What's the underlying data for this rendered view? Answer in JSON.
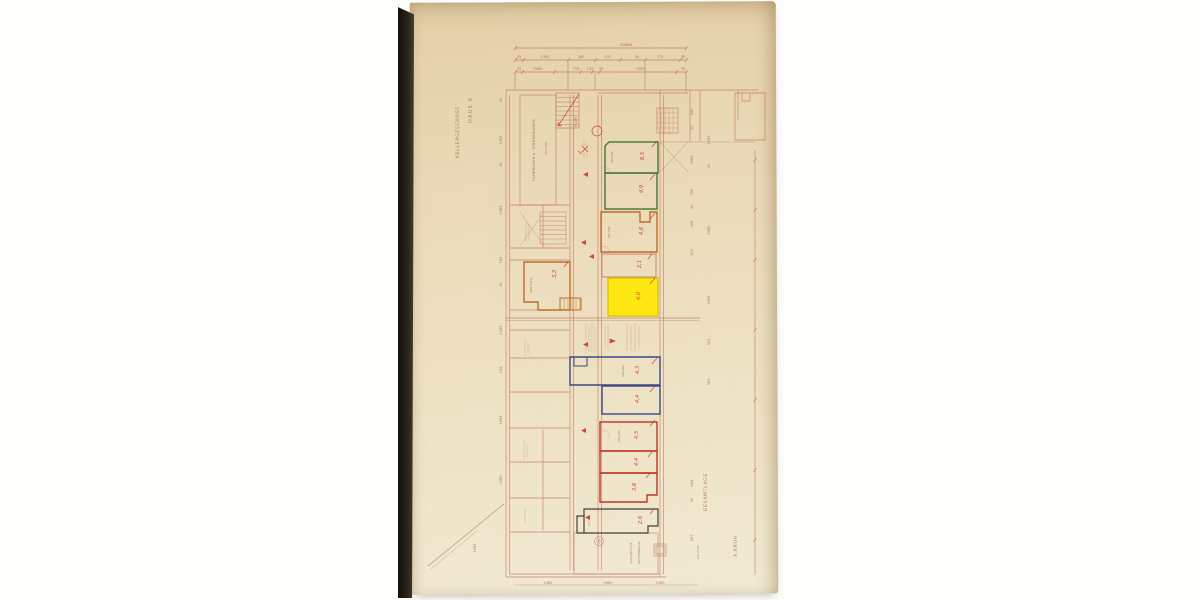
{
  "titles": {
    "haus": "HAUS 9",
    "geschoss": "KELLERGESCHOSS",
    "gesamtlage": "GESAMTLAGE",
    "architect": "A.KROH",
    "dg": "DG 2305"
  },
  "dims": {
    "total": "10485",
    "row2": [
      "35",
      "1395",
      "365",
      "437",
      "30",
      "775",
      "35"
    ],
    "row3": [
      "35",
      "3085",
      "715",
      "135",
      "35",
      "5085",
      "35"
    ],
    "left": [
      "35",
      "1395",
      "30",
      "2985",
      "765",
      "30",
      "2345",
      "245",
      "1985",
      "3085"
    ],
    "right1": [
      "343",
      "30",
      "3585",
      "765",
      "30",
      "305",
      "870"
    ],
    "right2": [
      "1065",
      "30",
      "3985",
      "2985",
      "305",
      "365"
    ],
    "right3": [
      "685",
      "30",
      "387"
    ],
    "bottom": [
      "1485",
      "3985",
      "2985"
    ],
    "diag": "1985"
  },
  "rooms": {
    "bike": "FAHRRÄDER u. KINDERWAGEN",
    "bike2": "BV 2000",
    "flur": "FLUR",
    "keller": "KELLER",
    "green1_mark": "8,5",
    "green2_mark": "4,9",
    "orange_mark": "4,6",
    "pink_mark": "2,1",
    "yellow_mark": "4,0",
    "abstell": "ABSTELLR.",
    "abstell_mark": "3,2",
    "blue1_mark": "4,3",
    "blue2_mark": "4,4",
    "red1_mark": "4,5",
    "red2_mark": "4,4",
    "red3_mark": "3,6",
    "dark_mark": "2,6",
    "dark_area": "10,5 m²",
    "wasch": "WASCHKÜCHE",
    "trocken": "TROCKENRAUM"
  },
  "colors": {
    "paper": "#ead9b6",
    "plan_line": "#b4604c",
    "highlight_yellow": "#ffe714",
    "room_green": "#4f7d3c",
    "room_blue": "#3c4787",
    "room_red": "#c23527",
    "room_orange": "#c16d28",
    "room_dark": "#454034",
    "handwriting": "#c2271b"
  }
}
